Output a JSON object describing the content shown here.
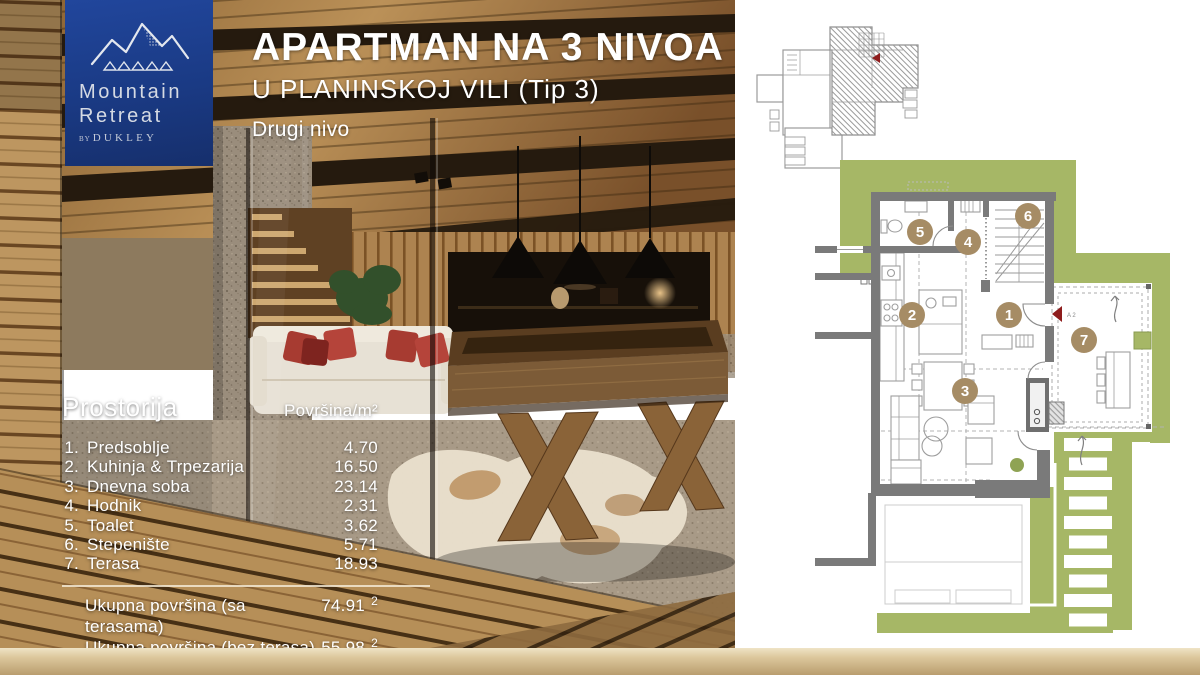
{
  "logo": {
    "line1": "Mountain",
    "line2": "Retreat",
    "by_prefix": "BY",
    "by_brand": "DUKLEY"
  },
  "header": {
    "title": "APARTMAN NA 3 NIVOA",
    "subtitle": "U PLANINSKOJ VILI (Tip 3)",
    "level_label": "Drugi nivo"
  },
  "areas_table": {
    "room_header": "Prostorija",
    "area_header": "Površina/m²",
    "rows": [
      {
        "num": "1.",
        "name": "Predsoblje",
        "area": "4.70"
      },
      {
        "num": "2.",
        "name": "Kuhinja & Trpezarija",
        "area": "16.50"
      },
      {
        "num": "3.",
        "name": "Dnevna soba",
        "area": "23.14"
      },
      {
        "num": "4.",
        "name": "Hodnik",
        "area": "2.31"
      },
      {
        "num": "5.",
        "name": "Toalet",
        "area": "3.62"
      },
      {
        "num": "6.",
        "name": "Stepenište",
        "area": "5.71"
      },
      {
        "num": "7.",
        "name": "Terasa",
        "area": "18.93"
      }
    ],
    "totals": [
      {
        "label": "Ukupna površina (sa terasama)",
        "value": "74.91",
        "unit_sup": "2"
      },
      {
        "label": "Ukupna površina (bez terasa)",
        "value": "55.98",
        "unit_sup": "2"
      }
    ]
  },
  "plan": {
    "marker_label": "A 2",
    "badges": [
      "1",
      "2",
      "3",
      "4",
      "5",
      "6",
      "7"
    ]
  },
  "colors": {
    "terrace_green": "#a6b766",
    "badge_tan": "#a68c65",
    "logo_blue": "#1c3f8e",
    "marker_red": "#8e1c1c",
    "gold_bar": "#c9b186",
    "wall_gray": "#7a7a7a"
  }
}
